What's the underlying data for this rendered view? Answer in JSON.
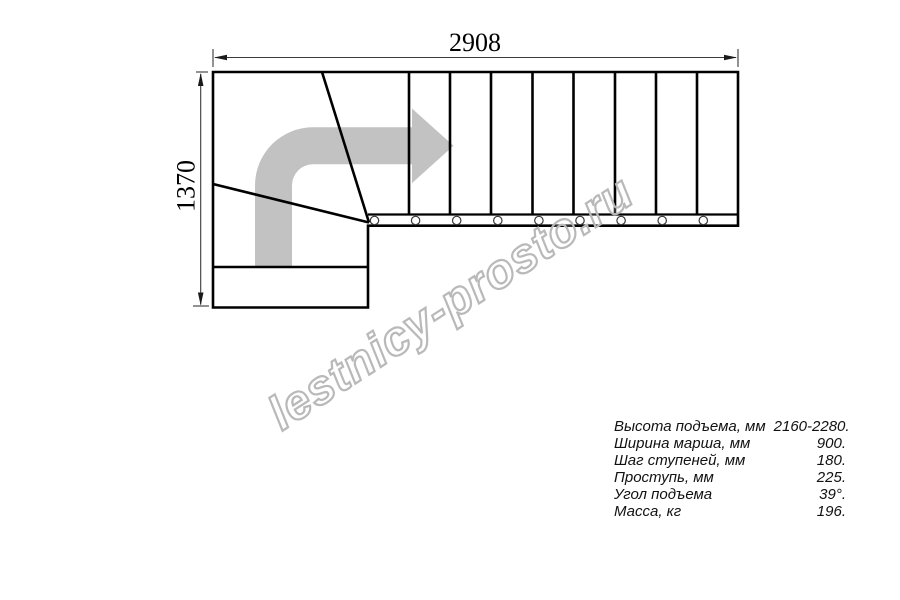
{
  "drawing": {
    "title": "L-shaped staircase plan (top view)",
    "dim_width_label": "2908",
    "dim_height_label": "1370"
  },
  "watermark": {
    "text": "lestnicy-prosto.ru"
  },
  "specs": {
    "rows": [
      {
        "label": "Высота подъема, мм",
        "value": "2160-2280."
      },
      {
        "label": "Ширина марша, мм",
        "value": "900."
      },
      {
        "label": "Шаг ступеней, мм",
        "value": "180."
      },
      {
        "label": "Проступь, мм",
        "value": "225."
      },
      {
        "label": "Угол подъема",
        "value": "39°."
      },
      {
        "label": "Масса, кг",
        "value": "196."
      }
    ]
  },
  "colors": {
    "line": "#000000",
    "dimension_line": "#3a3a3a",
    "direction_arrow_fill": "#c2c2c2",
    "watermark_outline": "#b9b9b9",
    "background": "#ffffff"
  }
}
